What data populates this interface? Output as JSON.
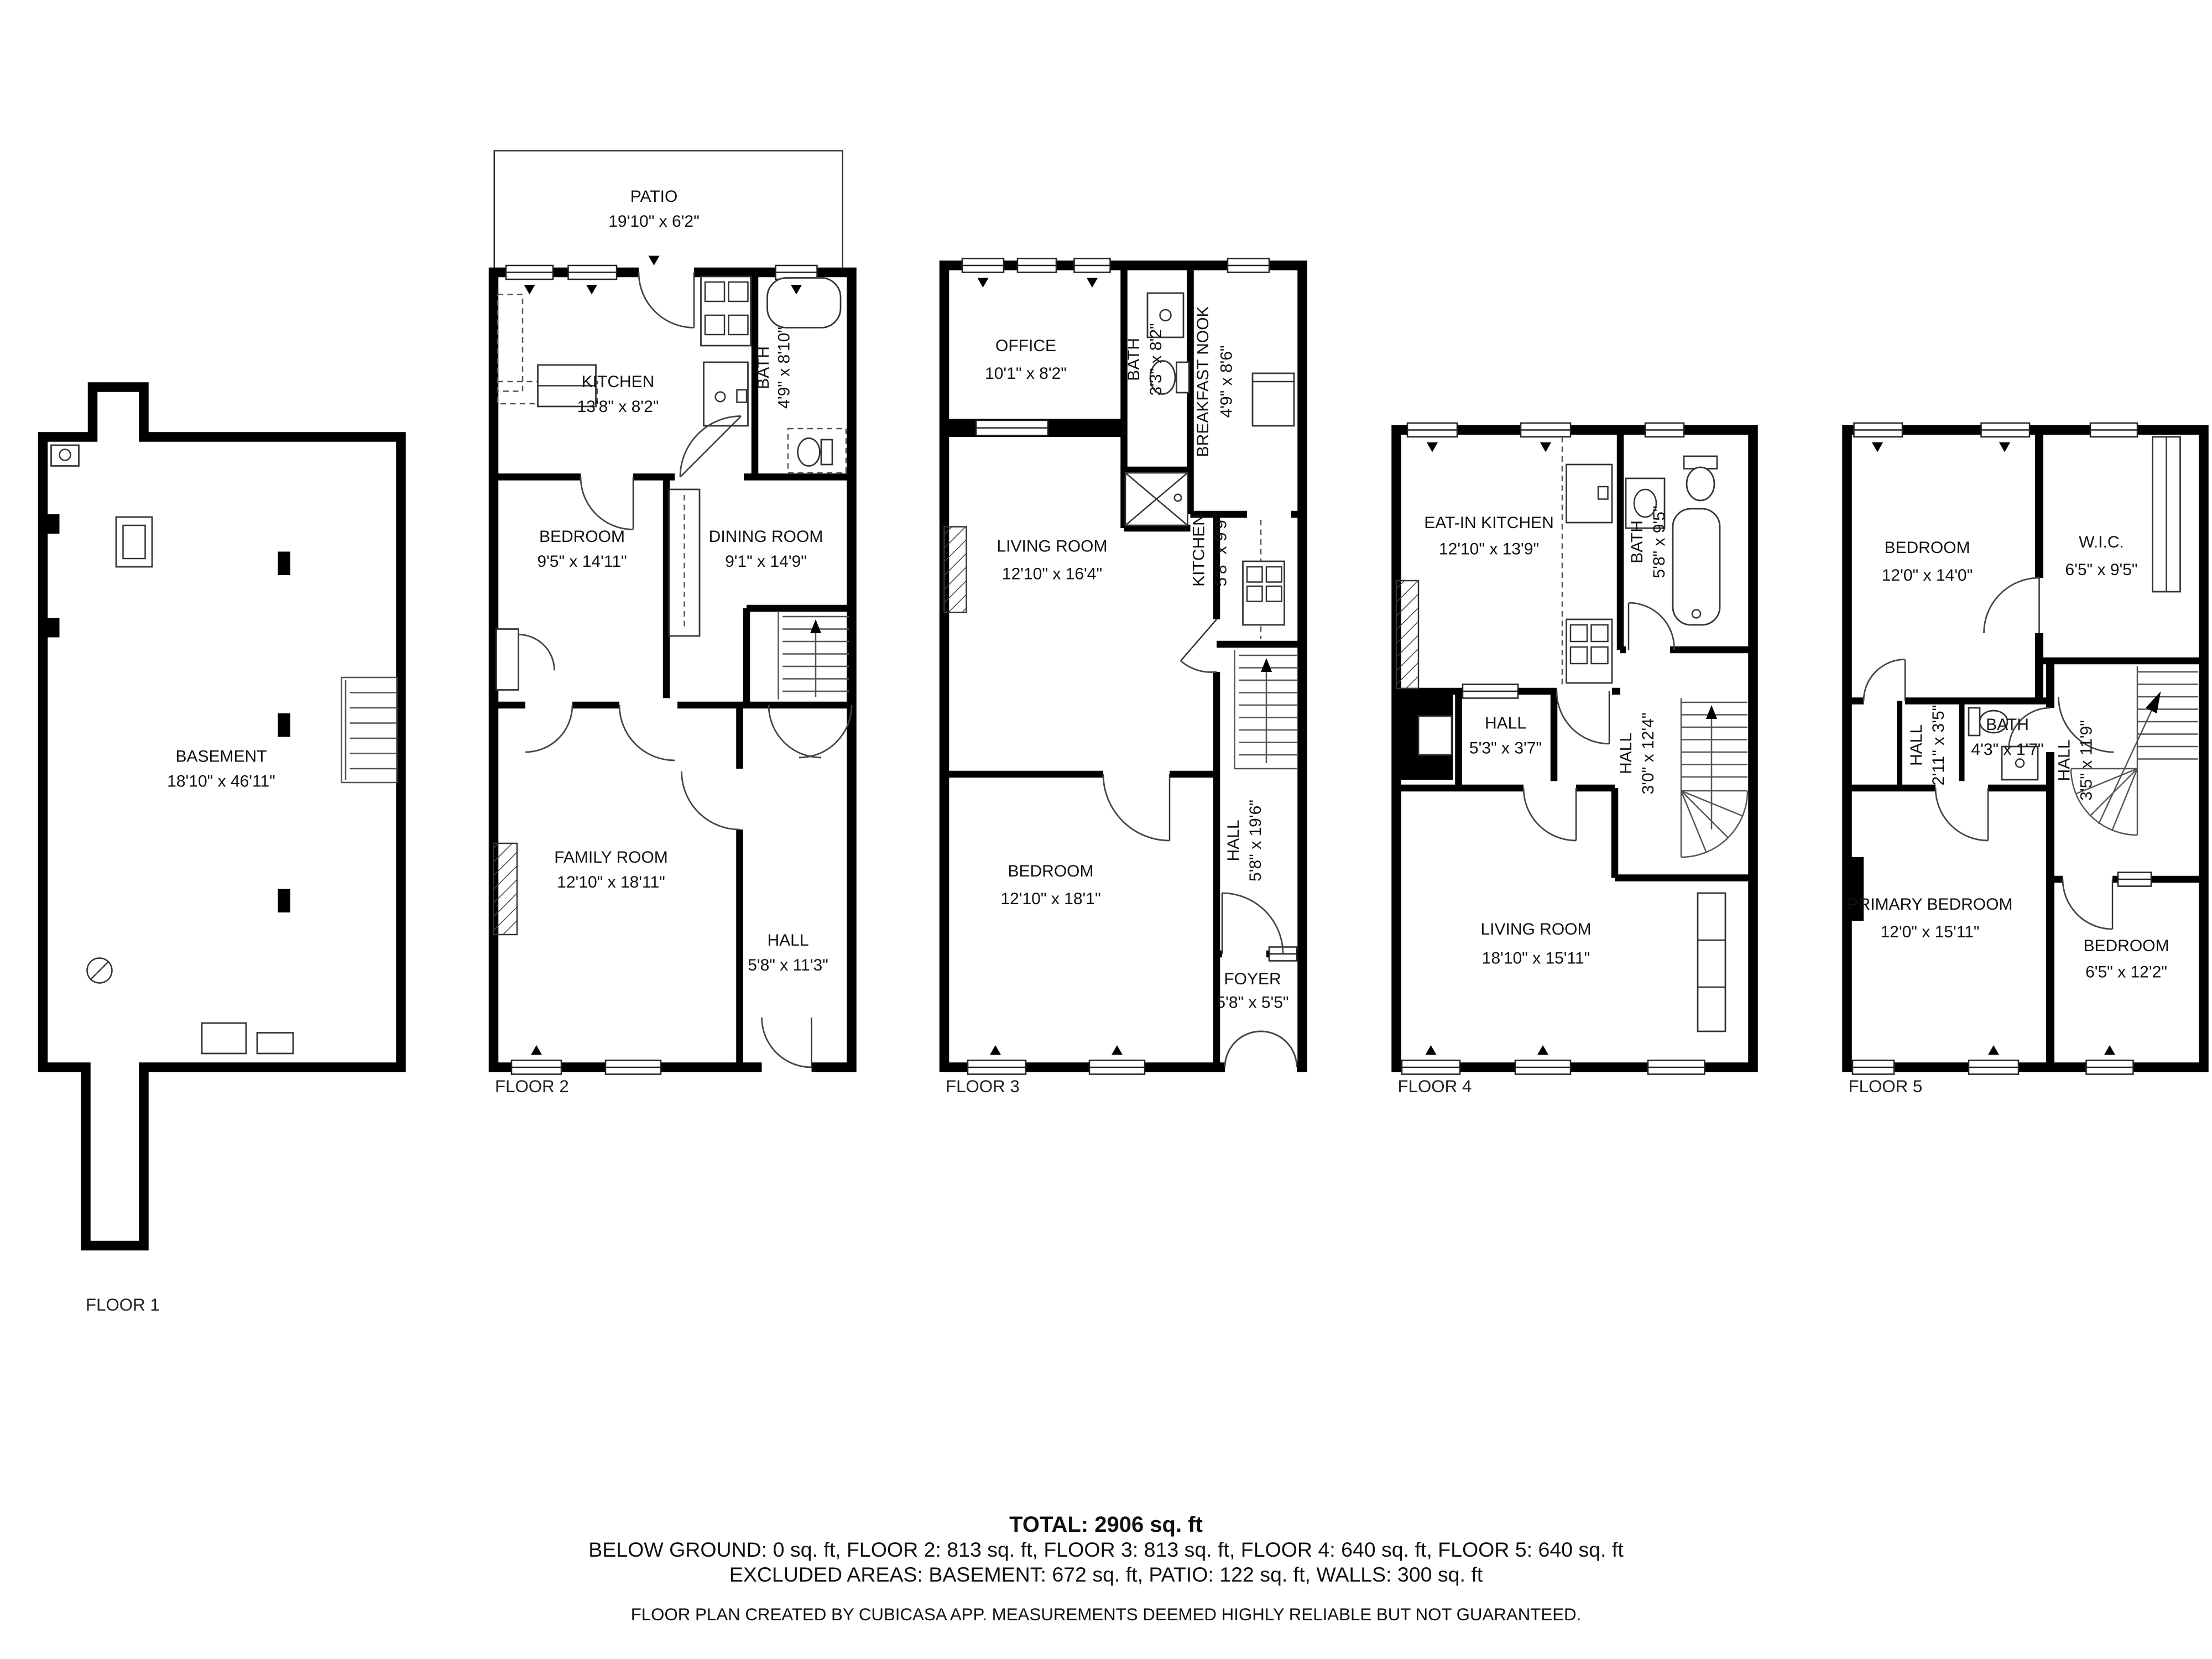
{
  "floors": [
    {
      "label": "FLOOR 1",
      "rooms": [
        {
          "name": "BASEMENT",
          "dims": "18'10\" x 46'11\""
        }
      ]
    },
    {
      "label": "FLOOR 2",
      "rooms": [
        {
          "name": "PATIO",
          "dims": "19'10\" x 6'2\""
        },
        {
          "name": "KITCHEN",
          "dims": "13'8\" x 8'2\""
        },
        {
          "name": "BATH",
          "dims": "4'9\" x 8'10\""
        },
        {
          "name": "BEDROOM",
          "dims": "9'5\" x 14'11\""
        },
        {
          "name": "DINING ROOM",
          "dims": "9'1\" x 14'9\""
        },
        {
          "name": "FAMILY ROOM",
          "dims": "12'10\" x 18'11\""
        },
        {
          "name": "HALL",
          "dims": "5'8\" x 11'3\""
        }
      ]
    },
    {
      "label": "FLOOR 3",
      "rooms": [
        {
          "name": "OFFICE",
          "dims": "10'1\" x 8'2\""
        },
        {
          "name": "BATH",
          "dims": "3'3\" x 8'2\""
        },
        {
          "name": "BREAKFAST NOOK",
          "dims": "4'9\" x 8'6\""
        },
        {
          "name": "LIVING ROOM",
          "dims": "12'10\" x 16'4\""
        },
        {
          "name": "KITCHEN",
          "dims": "5'8\" x 9'9\""
        },
        {
          "name": "BEDROOM",
          "dims": "12'10\" x 18'1\""
        },
        {
          "name": "HALL",
          "dims": "5'8\" x 19'6\""
        },
        {
          "name": "FOYER",
          "dims": "5'8\" x 5'5\""
        }
      ]
    },
    {
      "label": "FLOOR 4",
      "rooms": [
        {
          "name": "EAT-IN KITCHEN",
          "dims": "12'10\" x 13'9\""
        },
        {
          "name": "BATH",
          "dims": "5'8\" x 9'5\""
        },
        {
          "name": "HALL",
          "dims": "5'3\" x 3'7\""
        },
        {
          "name": "HALL",
          "dims": "3'0\" x 12'4\""
        },
        {
          "name": "LIVING ROOM",
          "dims": "18'10\" x 15'11\""
        }
      ]
    },
    {
      "label": "FLOOR 5",
      "rooms": [
        {
          "name": "BEDROOM",
          "dims": "12'0\" x 14'0\""
        },
        {
          "name": "W.I.C.",
          "dims": "6'5\" x 9'5\""
        },
        {
          "name": "HALL",
          "dims": "2'11\" x 3'5\""
        },
        {
          "name": "BATH",
          "dims": "4'3\" x 1'7\""
        },
        {
          "name": "HALL",
          "dims": "3'5\" x 11'9\""
        },
        {
          "name": "PRIMARY BEDROOM",
          "dims": "12'0\" x 15'11\""
        },
        {
          "name": "BEDROOM",
          "dims": "6'5\" x 12'2\""
        }
      ]
    }
  ],
  "summary": {
    "total": "TOTAL: 2906 sq. ft",
    "per_floor": "BELOW GROUND: 0 sq. ft, FLOOR 2: 813 sq. ft, FLOOR 3: 813 sq. ft, FLOOR 4: 640 sq. ft, FLOOR 5: 640 sq. ft",
    "excluded": "EXCLUDED AREAS: BASEMENT: 672 sq. ft, PATIO: 122 sq. ft, WALLS: 300 sq. ft",
    "disclaimer": "FLOOR PLAN CREATED BY CUBICASA APP. MEASUREMENTS DEEMED HIGHLY RELIABLE BUT NOT GUARANTEED."
  },
  "colors": {
    "wall": "#000000",
    "text": "#111111",
    "background": "#ffffff"
  }
}
